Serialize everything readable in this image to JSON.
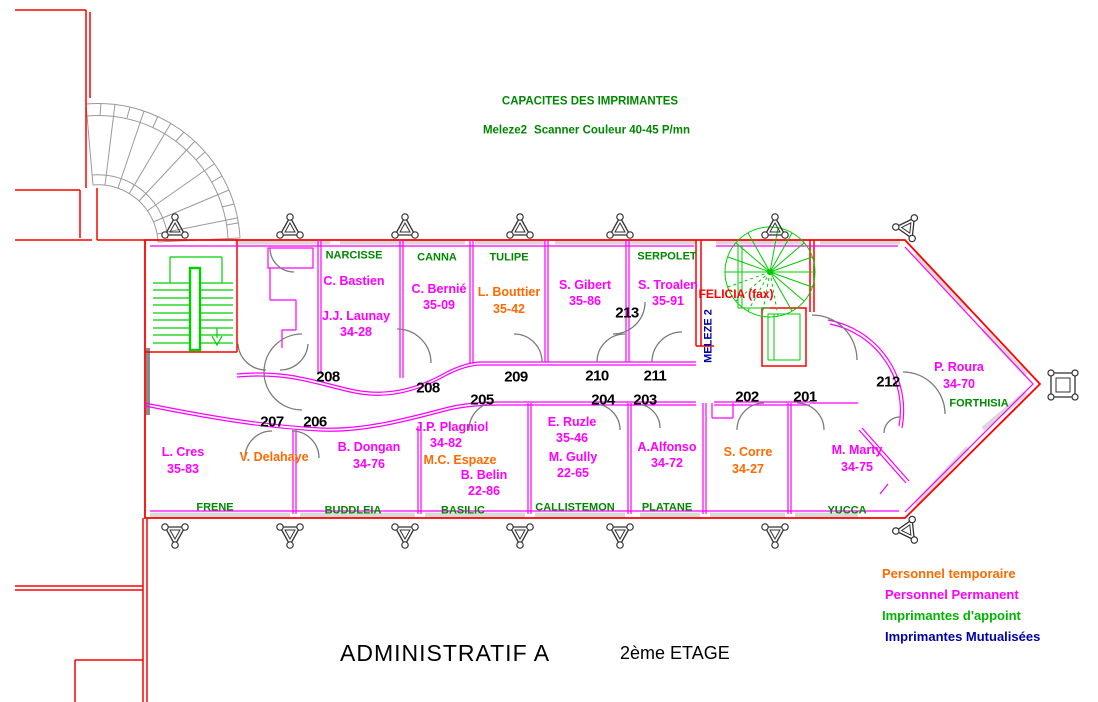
{
  "header": {
    "title": "CAPACITES DES IMPRIMANTES",
    "printer_name": "Meleze2",
    "printer_spec": "Scanner Couleur  40-45 P/mn"
  },
  "rooms": {
    "narcisse": {
      "name": "NARCISSE"
    },
    "canna": {
      "name": "CANNA"
    },
    "tulipe": {
      "name": "TULIPE"
    },
    "serpolet": {
      "name": "SERPOLET"
    },
    "forthisia": {
      "name": "FORTHISIA"
    },
    "frene": {
      "name": "FRENE"
    },
    "buddleia": {
      "name": "BUDDLEIA"
    },
    "basilic": {
      "name": "BASILIC"
    },
    "callistemon": {
      "name": "CALLISTEMON"
    },
    "platane": {
      "name": "PLATANE"
    },
    "yucca": {
      "name": "YUCCA"
    }
  },
  "special_labels": {
    "felicia": "FELICIA (fax)",
    "meleze2": "MELEZE 2"
  },
  "occupants": {
    "bastien": {
      "name": "C. Bastien",
      "phone": "",
      "type": "permanent"
    },
    "launay": {
      "name": "J.J. Launay",
      "phone": "34-28",
      "type": "permanent"
    },
    "bernie": {
      "name": "C. Bernié",
      "phone": "35-09",
      "type": "permanent"
    },
    "bouttier": {
      "name": "L. Bouttier",
      "phone": "35-42",
      "type": "temporaire"
    },
    "gibert": {
      "name": "S. Gibert",
      "phone": "35-86",
      "type": "permanent"
    },
    "troalen": {
      "name": "S. Troalen",
      "phone": "35-91",
      "type": "permanent"
    },
    "roura": {
      "name": "P. Roura",
      "phone": "34-70",
      "type": "permanent"
    },
    "cres": {
      "name": "L. Cres",
      "phone": "35-83",
      "type": "permanent"
    },
    "delahaye": {
      "name": "V. Delahaye",
      "phone": "",
      "type": "temporaire"
    },
    "dongan": {
      "name": "B. Dongan",
      "phone": "34-76",
      "type": "permanent"
    },
    "plagniol": {
      "name": "J.P. Plagniol",
      "phone": "34-82",
      "type": "permanent"
    },
    "espaze": {
      "name": "M.C. Espaze",
      "phone": "",
      "type": "temporaire"
    },
    "belin": {
      "name": "B. Belin",
      "phone": "22-86",
      "type": "permanent"
    },
    "ruzle": {
      "name": "E. Ruzle",
      "phone": "35-46",
      "type": "permanent"
    },
    "gully": {
      "name": "M. Gully",
      "phone": "22-65",
      "type": "permanent"
    },
    "alfonso": {
      "name": "A.Alfonso",
      "phone": "34-72",
      "type": "permanent"
    },
    "corre": {
      "name": "S. Corre",
      "phone": "34-27",
      "type": "temporaire"
    },
    "marty": {
      "name": "M. Marty",
      "phone": "34-75",
      "type": "permanent"
    }
  },
  "door_numbers": [
    "208",
    "208",
    "209",
    "210",
    "211",
    "213",
    "212",
    "207",
    "206",
    "205",
    "204",
    "203",
    "202",
    "201"
  ],
  "legend": {
    "items": [
      {
        "label": "Personnel temporaire",
        "color": "#ff6a00"
      },
      {
        "label": "Personnel Permanent",
        "color": "#ff00ff"
      },
      {
        "label": "Imprimantes d'appoint",
        "color": "#00b400"
      },
      {
        "label": "Imprimantes Mutualisées",
        "color": "#0000a8"
      }
    ]
  },
  "footer": {
    "building_label": "ADMINISTRATIF  A",
    "floor_label": "2ème ETAGE"
  },
  "colors": {
    "wall_exterior": "#ff0000",
    "wall_interior": "#ff00ff",
    "door": "#7a7a7a",
    "stairs": "#00d000",
    "room_name": "#008800",
    "personnel_permanent": "#ff00ff",
    "personnel_temporaire": "#ff6a00",
    "imprimantes_appoint": "#00b400",
    "imprimantes_mutualisees": "#0000a8",
    "fax": "#ff0000",
    "door_number": "#000000"
  }
}
